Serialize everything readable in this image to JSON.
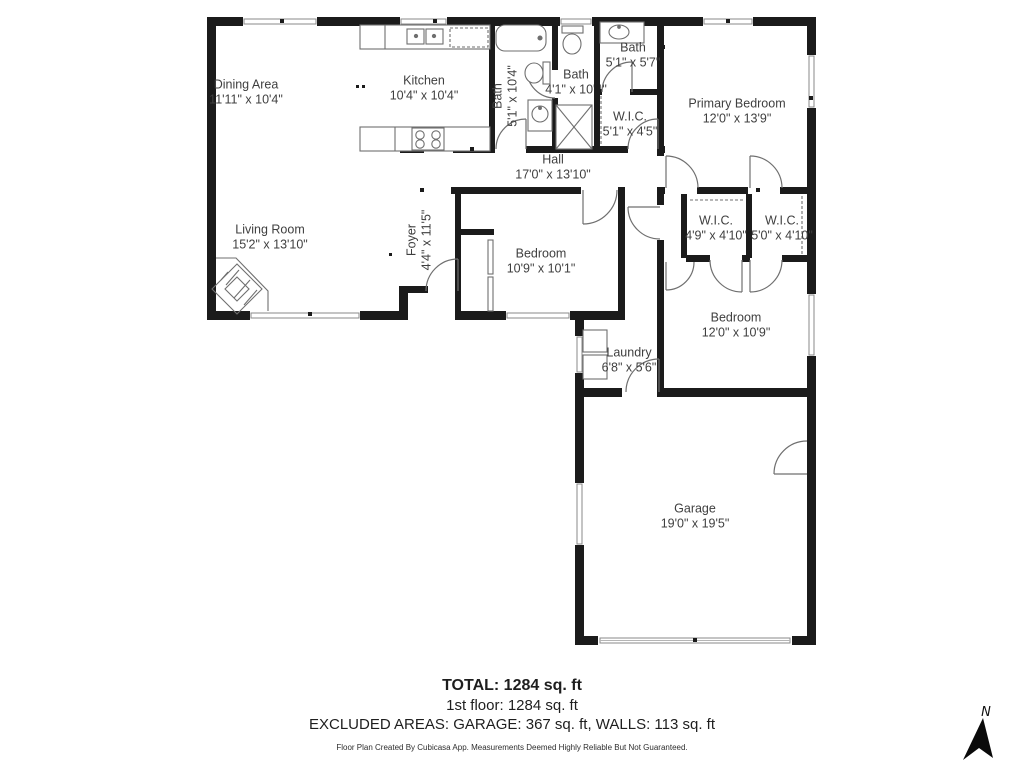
{
  "plan": {
    "rooms": [
      {
        "name": "Dining Area",
        "dims": "11'11\" x 10'4\""
      },
      {
        "name": "Kitchen",
        "dims": "10'4\" x 10'4\""
      },
      {
        "name": "Bath",
        "dims": "5'1\" x 10'4\""
      },
      {
        "name": "Bath",
        "dims": "4'1\" x 10'4\""
      },
      {
        "name": "Bath",
        "dims": "5'1\" x 5'7\""
      },
      {
        "name": "W.I.C.",
        "dims": "5'1\" x 4'5\""
      },
      {
        "name": "Primary Bedroom",
        "dims": "12'0\" x 13'9\""
      },
      {
        "name": "Hall",
        "dims": "17'0\" x 13'10\""
      },
      {
        "name": "Foyer",
        "dims": "4'4\" x 11'5\""
      },
      {
        "name": "Living Room",
        "dims": "15'2\" x 13'10\""
      },
      {
        "name": "Bedroom",
        "dims": "10'9\" x 10'1\""
      },
      {
        "name": "W.I.C.",
        "dims": "4'9\" x 4'10\""
      },
      {
        "name": "W.I.C.",
        "dims": "5'0\" x 4'10\""
      },
      {
        "name": "Bedroom",
        "dims": "12'0\" x 10'9\""
      },
      {
        "name": "Laundry",
        "dims": "6'8\" x 5'6\""
      },
      {
        "name": "Garage",
        "dims": "19'0\" x 19'5\""
      }
    ]
  },
  "summary": {
    "total": "TOTAL: 1284 sq. ft",
    "first_floor": "1st floor: 1284 sq. ft",
    "excluded_areas": "EXCLUDED AREAS: GARAGE: 367 sq. ft, WALLS: 113 sq. ft",
    "disclaimer": "Floor Plan Created By Cubicasa App. Measurements Deemed Highly Reliable But Not Guaranteed."
  },
  "compass": {
    "north_label": "N"
  },
  "colors": {
    "wall": "#1b1b1b",
    "fixture_stroke": "#707070",
    "label_text": "#3f3f3f"
  }
}
